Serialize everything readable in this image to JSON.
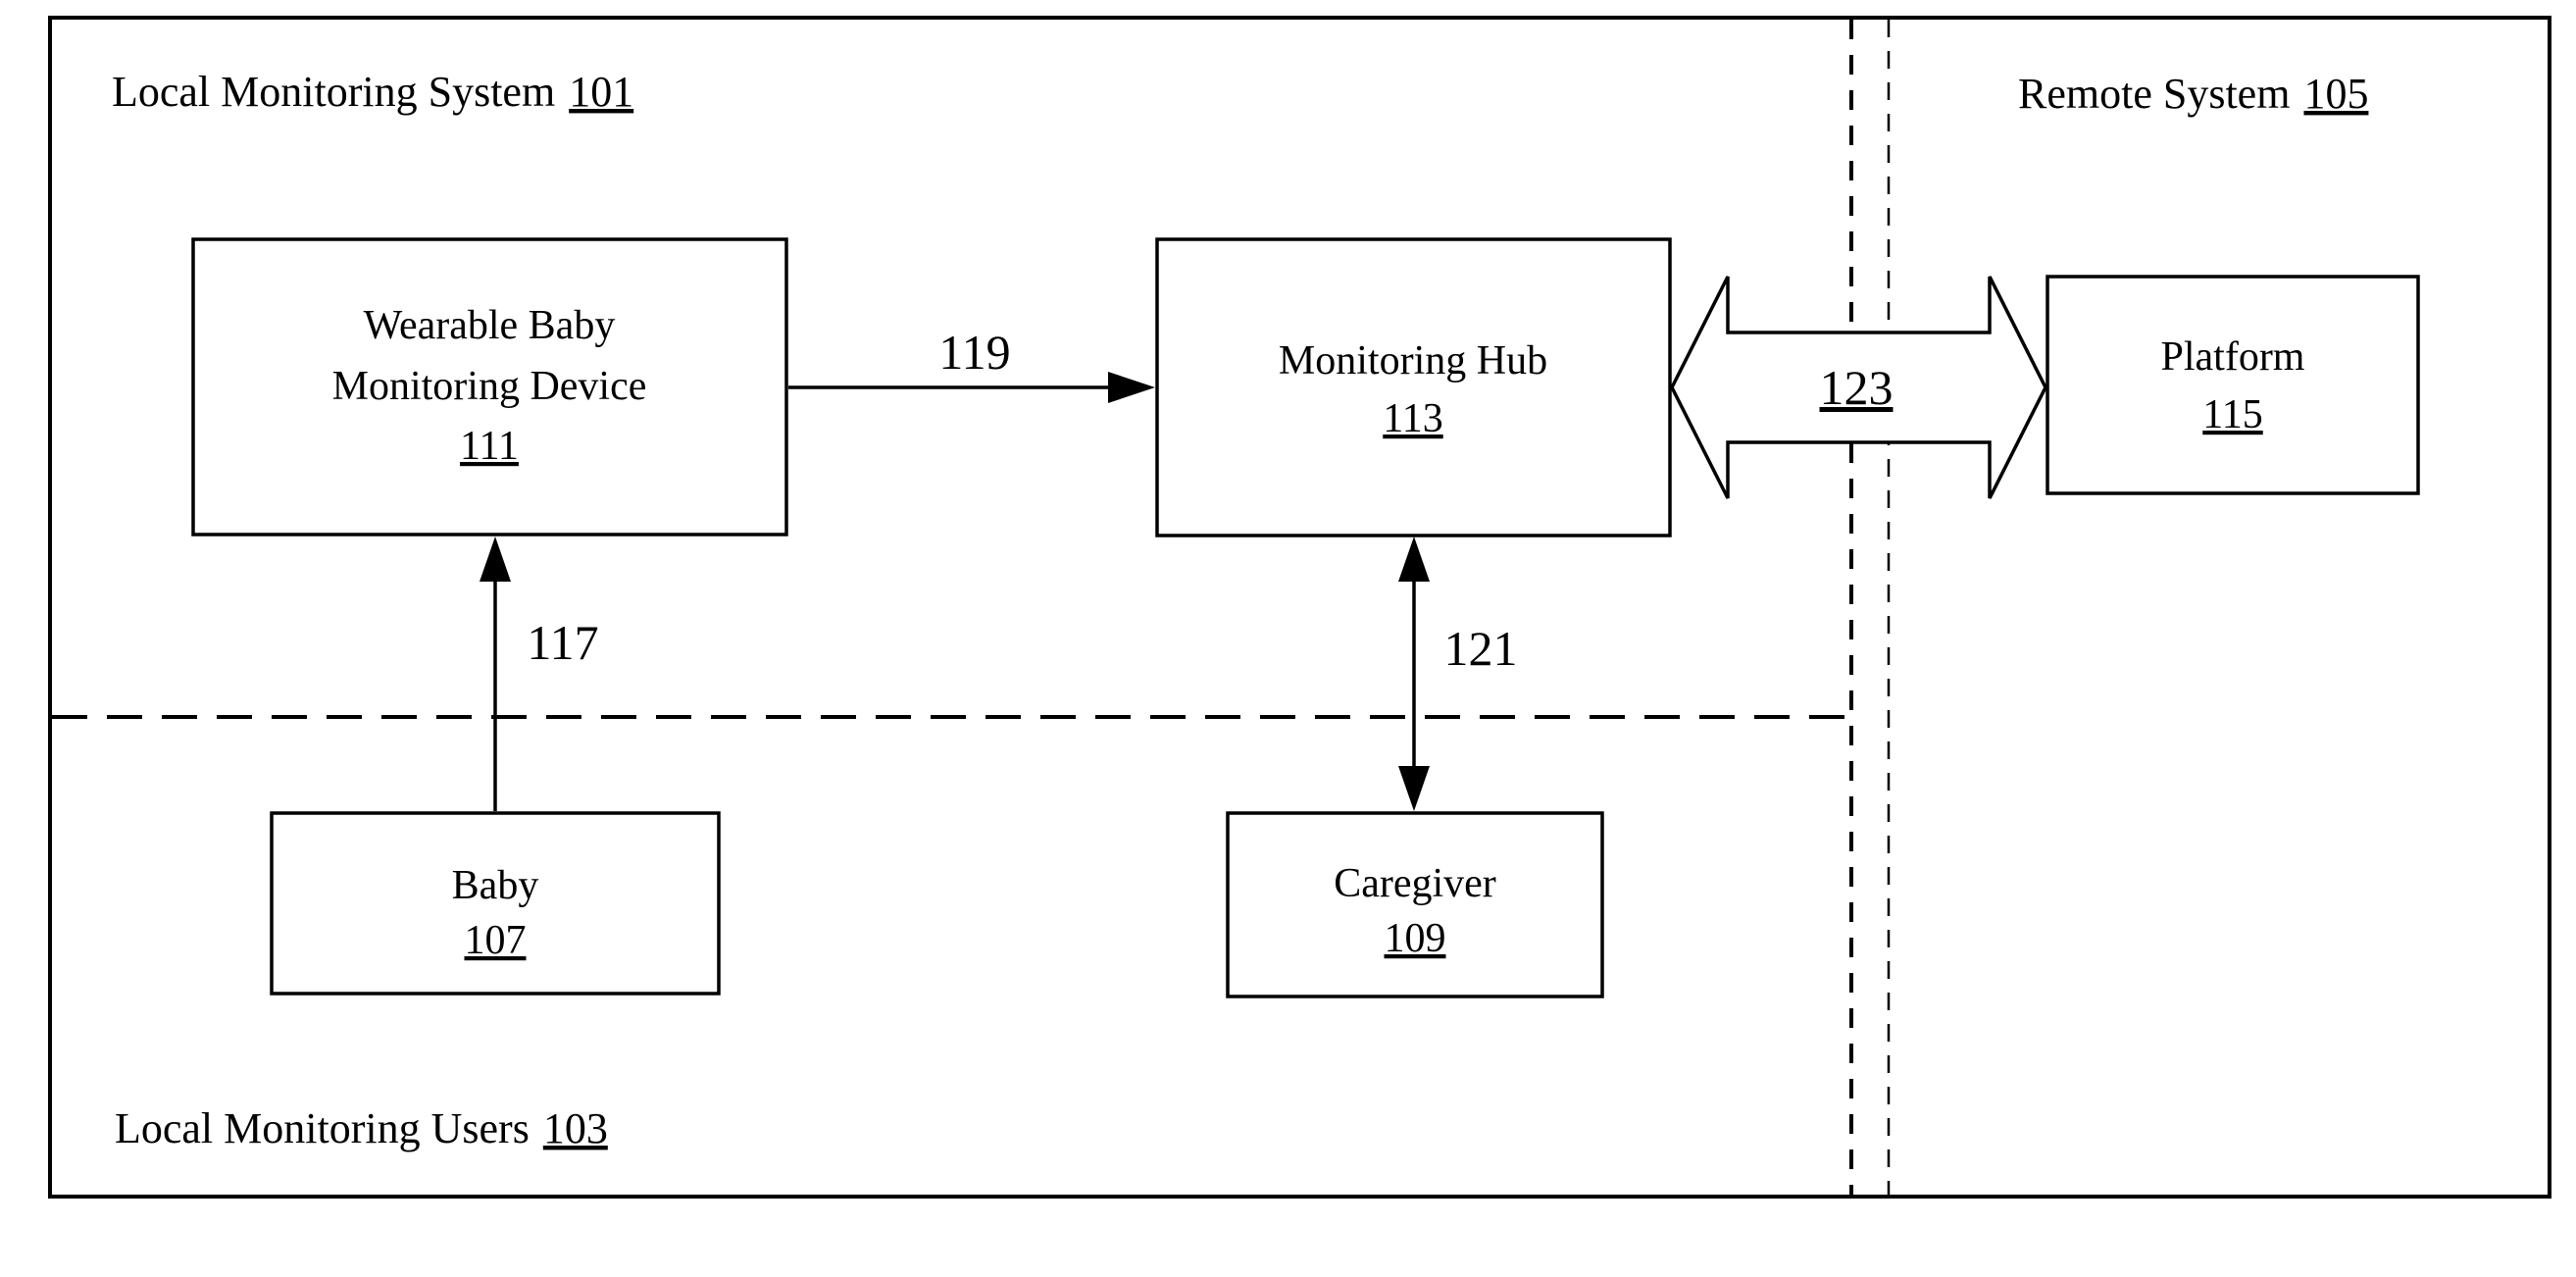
{
  "figure": {
    "background": "#ffffff",
    "line_color": "#000000",
    "regions": {
      "local_system": {
        "label": "Local Monitoring System",
        "ref": "101"
      },
      "remote_system": {
        "label": "Remote System",
        "ref": "105"
      },
      "local_users": {
        "label": "Local Monitoring Users",
        "ref": "103"
      }
    },
    "nodes": {
      "wearable_device": {
        "line1": "Wearable Baby",
        "line2": "Monitoring Device",
        "ref": "111"
      },
      "monitoring_hub": {
        "line1": "Monitoring Hub",
        "ref": "113"
      },
      "platform": {
        "line1": "Platform",
        "ref": "115"
      },
      "baby": {
        "line1": "Baby",
        "ref": "107"
      },
      "caregiver": {
        "line1": "Caregiver",
        "ref": "109"
      }
    },
    "connections": {
      "baby_to_device": {
        "ref": "117"
      },
      "device_to_hub": {
        "ref": "119"
      },
      "hub_to_caregiver": {
        "ref": "121"
      },
      "hub_to_platform": {
        "ref": "123"
      }
    }
  }
}
